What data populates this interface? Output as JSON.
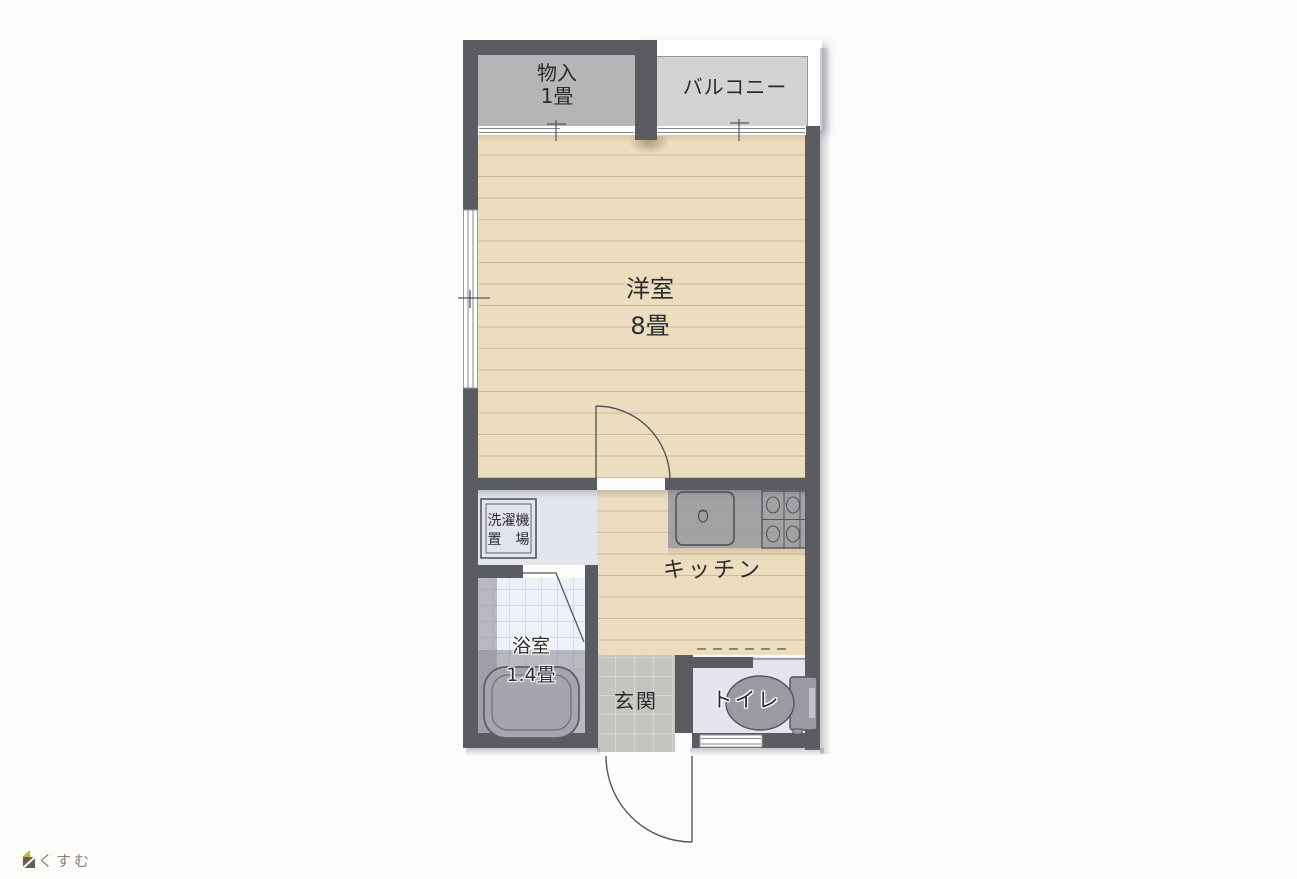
{
  "plan": {
    "type": "floor-plan",
    "rooms": {
      "closet": {
        "name": "物入",
        "size": "1畳"
      },
      "balcony": {
        "name": "バルコニー"
      },
      "western": {
        "name": "洋室",
        "size": "8畳"
      },
      "kitchen": {
        "name": "キッチン"
      },
      "laundry": {
        "line1": "洗濯機",
        "line2": "置　場"
      },
      "bathroom": {
        "name": "浴室",
        "size": "1.4畳"
      },
      "entrance": {
        "name": "玄関"
      },
      "toilet": {
        "name": "トイレ"
      }
    },
    "fixtures": [
      "kitchen-sink",
      "stove-2x2-burners",
      "bathtub",
      "toilet-bowl-with-tank",
      "washing-machine-pad"
    ],
    "colors": {
      "wall": "#5b5b62",
      "wood_floor": "#ebddbd",
      "wood_plank_line": "#c9bda0",
      "closet_floor": "#b5b5b7",
      "balcony_floor": "#d2d2d4",
      "laundry_floor": "#e3e5ed",
      "bath_tile": "#edf0f7",
      "entrance_tile": "#c6c4bf",
      "toilet_floor": "#e4e4ee",
      "fixture_gray": "#9a9aa2",
      "background": "#fcfcfb",
      "text": "#2b2b30"
    }
  },
  "logo": {
    "text": "らくすむ",
    "icon_colors": {
      "roof_green": "#a9c23f",
      "body_brown": "#6d5b4d"
    }
  }
}
